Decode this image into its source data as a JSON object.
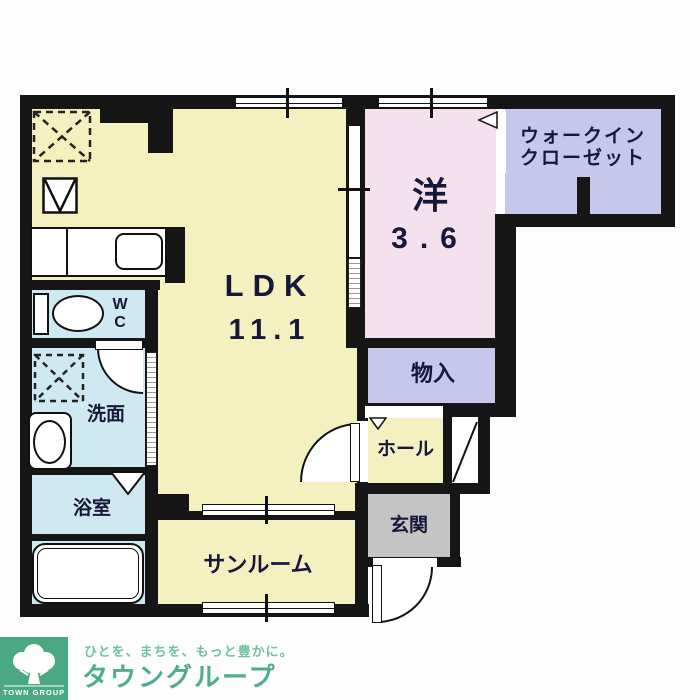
{
  "floorplan": {
    "rooms": {
      "ldk": {
        "name": "LDK",
        "size": "11.1"
      },
      "western": {
        "name": "洋",
        "size": "3.6"
      },
      "wic": {
        "line1": "ウォークイン",
        "line2": "クローゼット"
      },
      "storage": {
        "name": "物入"
      },
      "hall": {
        "name": "ホール"
      },
      "entrance": {
        "name": "玄関"
      },
      "sunroom": {
        "name": "サンルーム"
      },
      "washroom": {
        "name": "洗面"
      },
      "bathroom": {
        "name": "浴室"
      },
      "wc": {
        "letter_top": "W",
        "letter_bottom": "C"
      }
    },
    "colors": {
      "ldk_yellow": "#f5f0c0",
      "western_pink": "#f4e1ed",
      "closet_lavender": "#c7c7ec",
      "water_blue": "#cfe9f2",
      "entrance_gray": "#c4c4c4",
      "wall_black": "#161616",
      "label_navy": "#17173a"
    }
  },
  "footer": {
    "logo_text": "TOWN GROUP",
    "tagline": "ひとを、まちを、もっと豊かに。",
    "company": "タウングループ",
    "brand_green": "#4aa983",
    "text_green": "#4fae89"
  }
}
